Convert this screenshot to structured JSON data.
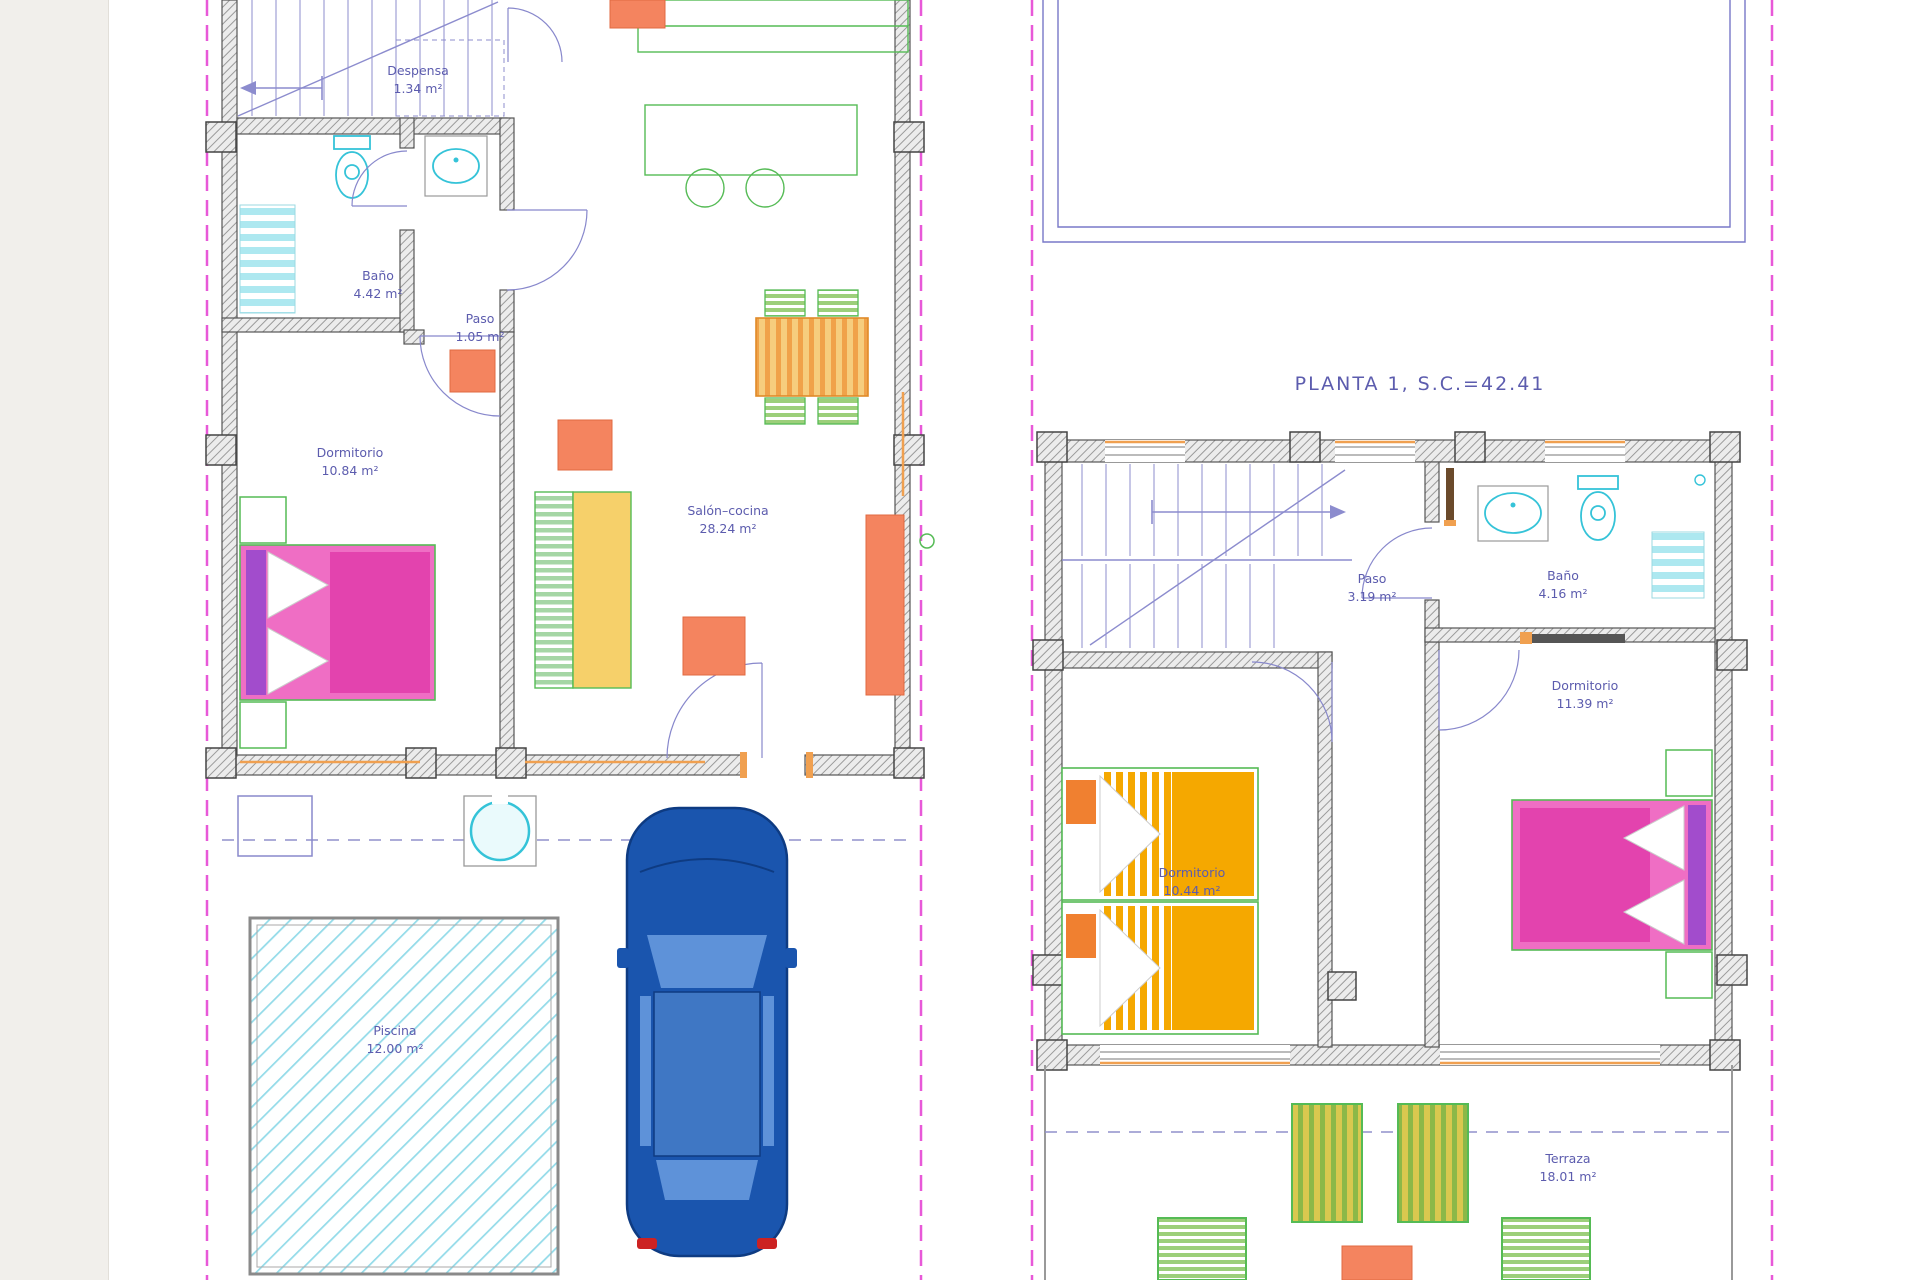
{
  "drawing": {
    "type": "architectural floor plan",
    "plans": {
      "ground_floor": {
        "rooms": [
          {
            "name": "Despensa",
            "area": "1.34 m²"
          },
          {
            "name": "Baño",
            "area": "4.42 m²"
          },
          {
            "name": "Paso",
            "area": "1.05 m²"
          },
          {
            "name": "Dormitorio",
            "area": "10.84 m²"
          },
          {
            "name": "Salón–cocina",
            "area": "28.24 m²"
          },
          {
            "name": "Piscina",
            "area": "12.00 m²"
          }
        ]
      },
      "first_floor": {
        "title": "PLANTA 1, S.C.=42.41",
        "rooms": [
          {
            "name": "Paso",
            "area": "3.19 m²"
          },
          {
            "name": "Baño",
            "area": "4.16 m²"
          },
          {
            "name": "Dormitorio",
            "area": "11.39 m²"
          },
          {
            "name": "Dormitorio",
            "area": "10.44 m²"
          },
          {
            "name": "Terraza",
            "area": "18.01 m²"
          }
        ]
      }
    },
    "colors": {
      "label_text": "#5c5cae",
      "boundary_magenta": "#e858d8",
      "wall_hatch_gray": "#9a9a9a",
      "stair_blue": "#8c8cce",
      "bed_pink": "#ef6ec4",
      "bed_magenta": "#e343ae",
      "bed_purple": "#a24ccc",
      "bed_orange": "#f5a800",
      "furniture_salmon": "#f4845f",
      "furniture_green": "#55bb55",
      "table_yellow": "#f6c36a",
      "fixture_cyan": "#35c3d8",
      "pool_cyan": "#93dbe9",
      "car_blue": "#1a55ae",
      "window_orange": "#f0a050"
    }
  }
}
